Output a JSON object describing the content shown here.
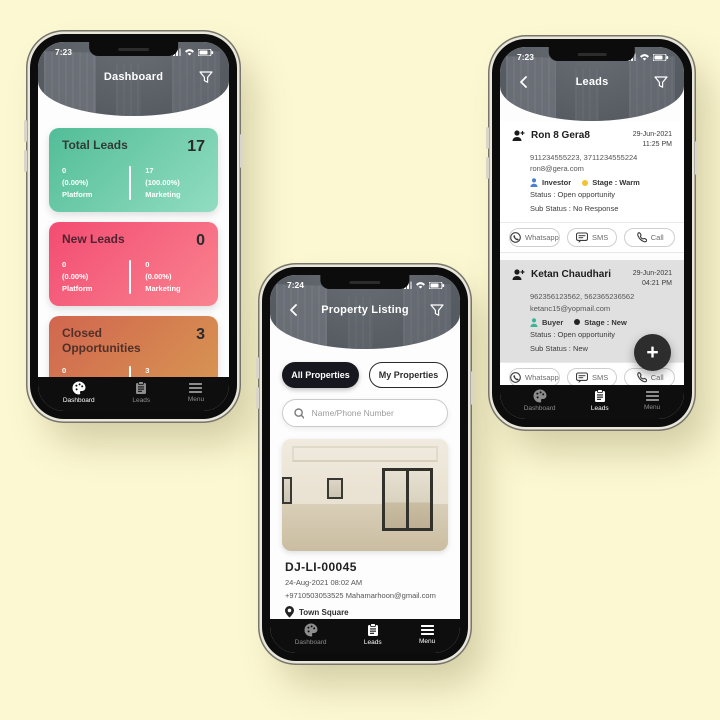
{
  "colors": {
    "page_bg": "#fcf8d2",
    "header_bg": "#565b62",
    "nav_bg": "#0e0e0e",
    "fab_bg": "#2d2d2d",
    "lead_card_gray": "#e0e0e0"
  },
  "dashboard_phone": {
    "status_time": "7:23",
    "header_title": "Dashboard",
    "cards": [
      {
        "title": "Total Leads",
        "value": "17",
        "left_count": "0",
        "left_pct": "(0.00%)",
        "left_label": "Platform",
        "right_count": "17",
        "right_pct": "(100.00%)",
        "right_label": "Marketing",
        "grad_from": "#52bd98",
        "grad_to": "#92ddc1",
        "title_color": "#313b38"
      },
      {
        "title": "New Leads",
        "value": "0",
        "left_count": "0",
        "left_pct": "(0.00%)",
        "left_label": "Platform",
        "right_count": "0",
        "right_pct": "(0.00%)",
        "right_label": "Marketing",
        "grad_from": "#f34c72",
        "grad_to": "#f9838f",
        "title_color": "#4f2430"
      },
      {
        "title": "Closed Opportunities",
        "value": "3",
        "left_count": "0",
        "left_pct": "(0.00%)",
        "left_label": "Platform",
        "right_count": "3",
        "right_pct": "(100.00%)",
        "right_label": "Marketing",
        "grad_from": "#d1664f",
        "grad_to": "#d89a52",
        "title_color": "#51302a"
      }
    ],
    "nav": {
      "dashboard": "Dashboard",
      "leads": "Leads",
      "menu": "Menu"
    }
  },
  "listing_phone": {
    "status_time": "7:24",
    "header_title": "Property Listing",
    "tabs": {
      "all": "All Properties",
      "my": "My Properties"
    },
    "search_placeholder": "Name/Phone Number",
    "property": {
      "code": "DJ-LI-00045",
      "datetime": "24-Aug-2021 08:02 AM",
      "contact": "+9710503053525 Mahamarhoon@gmail.com",
      "community": "Town Square",
      "city": "Dubai",
      "beds": "3 Beds",
      "area": "1652",
      "type": "Rental"
    },
    "nav": {
      "dashboard": "Dashboard",
      "leads": "Leads",
      "menu": "Menu"
    }
  },
  "leads_phone": {
    "status_time": "7:23",
    "header_title": "Leads",
    "actions": {
      "whatsapp": "Whatsapp",
      "sms": "SMS",
      "call": "Call"
    },
    "fab_label": "+",
    "leads": [
      {
        "name": "Ron 8 Gera8",
        "date": "29-Jun-2021",
        "time": "11:25 PM",
        "phones": "911234555223, 3711234555224",
        "email": "ron8@gera.com",
        "role": "Investor",
        "role_color": "#4a7fd4",
        "stage": "Stage : Warm",
        "stage_color": "#f2c230",
        "status": "Status : Open opportunity",
        "sub_status": "Sub Status : No Response",
        "bg": "#ffffff"
      },
      {
        "name": "Ketan Chaudhari",
        "date": "29-Jun-2021",
        "time": "04:21 PM",
        "phones": "962356123562, 562365236562",
        "email": "ketanc15@yopmail.com",
        "role": "Buyer",
        "role_color": "#3bb598",
        "stage": "Stage : New",
        "stage_color": "#222222",
        "status": "Status : Open opportunity",
        "sub_status": "Sub Status : New",
        "bg": "#e0e0e0"
      },
      {
        "name": "Ketan Chaudhari",
        "date": "29-Jun-2021",
        "time": "04:16 PM",
        "phones": "962356123562, 562365236562",
        "email": "ketanc15@yopmail.com",
        "role": "Buyer",
        "role_color": "#3bb598",
        "stage": "Stage : New",
        "stage_color": "#222222",
        "status": "Status : Open opportunity",
        "sub_status": "Sub Status : New",
        "bg": "#e0e0e0"
      }
    ],
    "nav": {
      "dashboard": "Dashboard",
      "leads": "Leads",
      "menu": "Menu"
    }
  }
}
